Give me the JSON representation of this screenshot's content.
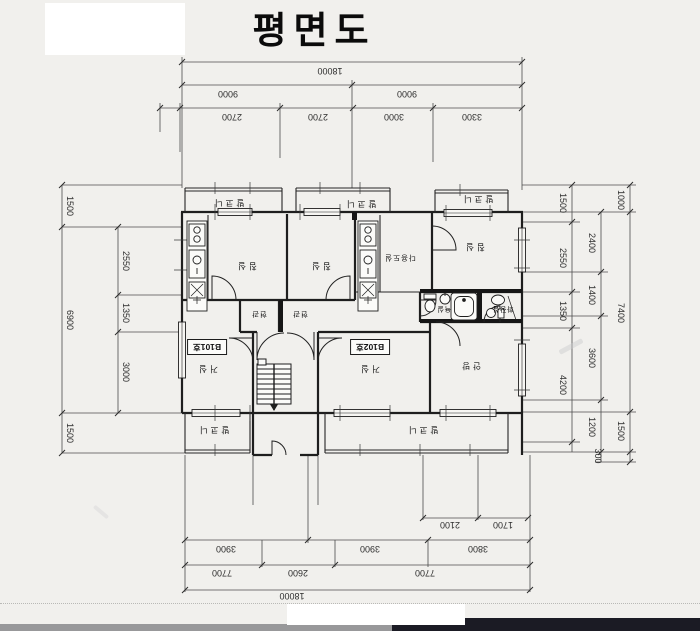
{
  "title": "평면도",
  "dims": {
    "top": {
      "total": "18000",
      "half_left": "9000",
      "half_right": "9000",
      "row3": [
        "2700",
        "2700",
        "3000",
        "3300"
      ]
    },
    "bottom": {
      "short": [
        "2100",
        "1700"
      ],
      "row2": [
        "3900",
        "3900",
        "3800"
      ],
      "row3": [
        "7700",
        "2600",
        "7700"
      ],
      "total": "18000"
    },
    "left": {
      "outer": [
        "1500",
        "6900",
        "1500"
      ],
      "inner": [
        "2550",
        "1350",
        "3000"
      ]
    },
    "right": {
      "inner": [
        "1500",
        "2550",
        "1350",
        "4200"
      ],
      "middle": [
        "2400",
        "1400",
        "3600",
        "1200",
        "300"
      ],
      "outer": [
        "1000",
        "7400",
        "1500"
      ]
    }
  },
  "rooms": {
    "balcony": "발코니",
    "bedroom": "침실",
    "master_bedroom": "안방",
    "living": "거실",
    "utility": "다용도실",
    "entry": "현관",
    "bath": "욕실",
    "toilet": "화장실",
    "unit1": "B101호",
    "unit2": "B102호"
  }
}
